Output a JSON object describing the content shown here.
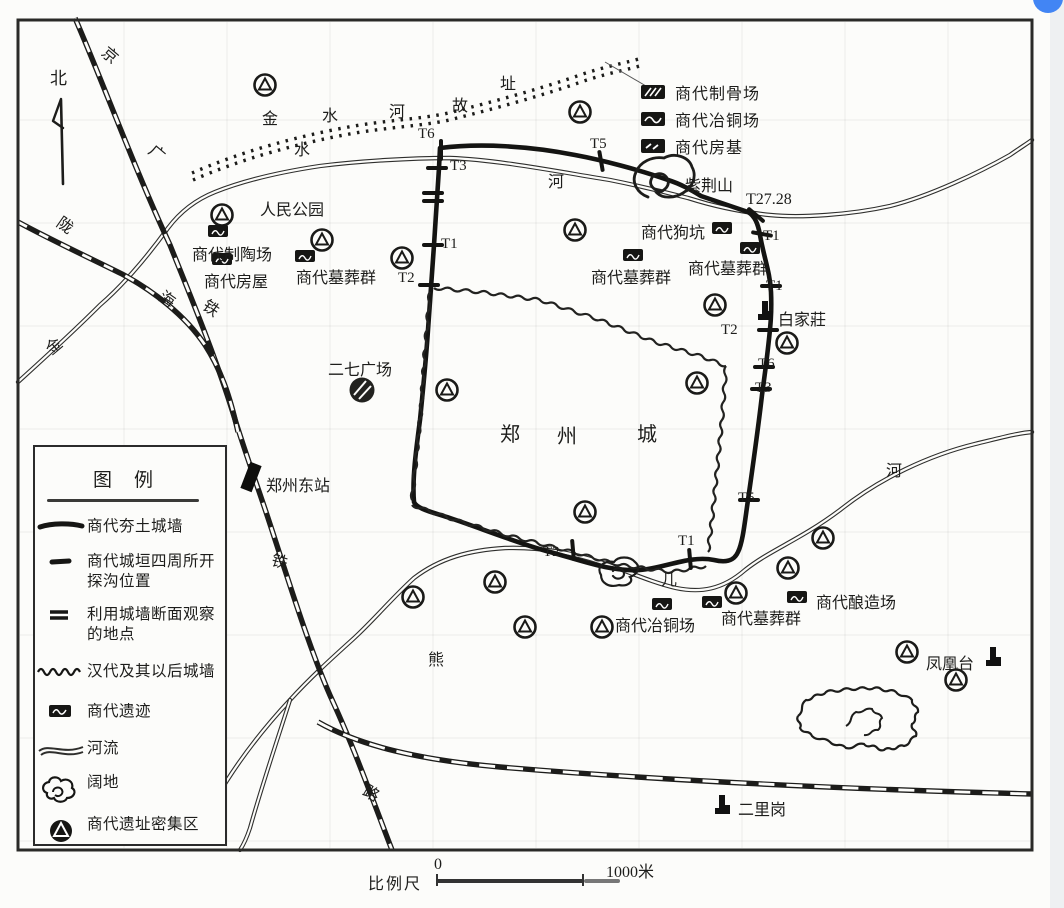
{
  "page": {
    "background": "#fcfcfa",
    "ink": "#1d1d1b",
    "accent_blue": "#4285f4"
  },
  "map": {
    "title_city": "郑州城",
    "labels": [
      {
        "text": "北",
        "x": 50,
        "y": 64,
        "size": 17,
        "rot": 0
      },
      {
        "text": "京",
        "x": 103,
        "y": 42,
        "size": 16,
        "rot": 40
      },
      {
        "text": "广",
        "x": 150,
        "y": 140,
        "size": 16,
        "rot": 40
      },
      {
        "text": "陇",
        "x": 58,
        "y": 212,
        "size": 16,
        "rot": 35
      },
      {
        "text": "海",
        "x": 160,
        "y": 286,
        "size": 16,
        "rot": 35
      },
      {
        "text": "铁",
        "x": 204,
        "y": 295,
        "size": 16,
        "rot": 35
      },
      {
        "text": "金",
        "x": 45,
        "y": 333,
        "size": 16,
        "rot": -40
      },
      {
        "text": "铁",
        "x": 272,
        "y": 548,
        "size": 16,
        "rot": 15
      },
      {
        "text": "路",
        "x": 364,
        "y": 780,
        "size": 16,
        "rot": 30
      },
      {
        "text": "金",
        "x": 262,
        "y": 105,
        "size": 16,
        "rot": 0
      },
      {
        "text": "水",
        "x": 322,
        "y": 102,
        "size": 16,
        "rot": 0
      },
      {
        "text": "河",
        "x": 389,
        "y": 98,
        "size": 16,
        "rot": 0
      },
      {
        "text": "故",
        "x": 452,
        "y": 92,
        "size": 16,
        "rot": 0
      },
      {
        "text": "址",
        "x": 500,
        "y": 70,
        "size": 16,
        "rot": 0
      },
      {
        "text": "水",
        "x": 294,
        "y": 136,
        "size": 16,
        "rot": 0
      },
      {
        "text": "河",
        "x": 548,
        "y": 168,
        "size": 16,
        "rot": 0
      },
      {
        "text": "人民公园",
        "x": 260,
        "y": 196,
        "size": 16,
        "rot": 0
      },
      {
        "text": "商代制陶场",
        "x": 192,
        "y": 241,
        "size": 16,
        "rot": 0
      },
      {
        "text": "商代房屋",
        "x": 204,
        "y": 268,
        "size": 16,
        "rot": 0
      },
      {
        "text": "商代墓葬群",
        "x": 296,
        "y": 264,
        "size": 16,
        "rot": 0
      },
      {
        "text": "二七广场",
        "x": 328,
        "y": 356,
        "size": 16,
        "rot": 0
      },
      {
        "text": "郑州东站",
        "x": 266,
        "y": 472,
        "size": 16,
        "rot": 0
      },
      {
        "text": "郑",
        "x": 500,
        "y": 418,
        "size": 20,
        "rot": 0
      },
      {
        "text": "州",
        "x": 557,
        "y": 420,
        "size": 20,
        "rot": 0
      },
      {
        "text": "城",
        "x": 637,
        "y": 418,
        "size": 20,
        "rot": 0
      },
      {
        "text": "商代墓葬群",
        "x": 591,
        "y": 264,
        "size": 16,
        "rot": 0
      },
      {
        "text": "商代狗坑",
        "x": 641,
        "y": 219,
        "size": 16,
        "rot": 0
      },
      {
        "text": "紫荆山",
        "x": 685,
        "y": 172,
        "size": 16,
        "rot": 0
      },
      {
        "text": "T27.28",
        "x": 746,
        "y": 191,
        "size": 16,
        "rot": 0
      },
      {
        "text": "商代墓葬群",
        "x": 688,
        "y": 255,
        "size": 16,
        "rot": 0
      },
      {
        "text": "白家莊",
        "x": 778,
        "y": 306,
        "size": 16,
        "rot": 0
      },
      {
        "text": "河",
        "x": 886,
        "y": 457,
        "size": 16,
        "rot": 0
      },
      {
        "text": "熊",
        "x": 428,
        "y": 646,
        "size": 16,
        "rot": 0
      },
      {
        "text": "儿",
        "x": 661,
        "y": 566,
        "size": 16,
        "rot": 0
      },
      {
        "text": "商代冶铜场",
        "x": 615,
        "y": 612,
        "size": 16,
        "rot": 0
      },
      {
        "text": "商代墓葬群",
        "x": 721,
        "y": 605,
        "size": 16,
        "rot": 0
      },
      {
        "text": "商代酿造场",
        "x": 816,
        "y": 589,
        "size": 16,
        "rot": 0
      },
      {
        "text": "凤凰台",
        "x": 926,
        "y": 650,
        "size": 16,
        "rot": 0
      },
      {
        "text": "二里岗",
        "x": 738,
        "y": 796,
        "size": 16,
        "rot": 0
      },
      {
        "text": "T6",
        "x": 418,
        "y": 126,
        "size": 15,
        "rot": 0
      },
      {
        "text": "T3",
        "x": 450,
        "y": 158,
        "size": 15,
        "rot": 0
      },
      {
        "text": "T5",
        "x": 590,
        "y": 136,
        "size": 15,
        "rot": 0
      },
      {
        "text": "T1",
        "x": 441,
        "y": 236,
        "size": 15,
        "rot": 0
      },
      {
        "text": "T2",
        "x": 398,
        "y": 270,
        "size": 15,
        "rot": 0
      },
      {
        "text": "T1",
        "x": 763,
        "y": 228,
        "size": 15,
        "rot": 0
      },
      {
        "text": "T1",
        "x": 766,
        "y": 278,
        "size": 15,
        "rot": 0
      },
      {
        "text": "T2",
        "x": 721,
        "y": 322,
        "size": 15,
        "rot": 0
      },
      {
        "text": "T6",
        "x": 758,
        "y": 356,
        "size": 15,
        "rot": 0
      },
      {
        "text": "T3",
        "x": 755,
        "y": 380,
        "size": 15,
        "rot": 0
      },
      {
        "text": "T5",
        "x": 738,
        "y": 490,
        "size": 15,
        "rot": 0
      },
      {
        "text": "T2",
        "x": 543,
        "y": 544,
        "size": 15,
        "rot": 0
      },
      {
        "text": "T1",
        "x": 678,
        "y": 533,
        "size": 15,
        "rot": 0
      }
    ]
  },
  "mini_legend": {
    "items": [
      {
        "label": "商代制骨场"
      },
      {
        "label": "商代冶铜场"
      },
      {
        "label": "商代房基"
      }
    ]
  },
  "legend": {
    "title": "图例",
    "items": [
      {
        "label": "商代夯土城墙"
      },
      {
        "label": "商代城垣四周所开探沟位置"
      },
      {
        "label": "利用城墙断面观察的地点"
      },
      {
        "label": "汉代及其以后城墙"
      },
      {
        "label": "商代遗迹"
      },
      {
        "label": "河流"
      },
      {
        "label": "阔地"
      },
      {
        "label": "商代遗址密集区"
      }
    ]
  },
  "scale": {
    "label": "比例尺",
    "start": "0",
    "end": "1000米"
  }
}
